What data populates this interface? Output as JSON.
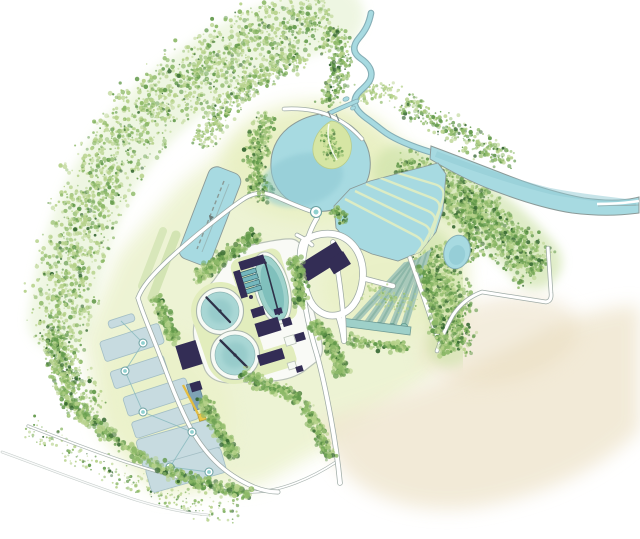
{
  "palette": {
    "paper": "#ffffff",
    "wash_green": "#edf3d2",
    "wash_bright": "#e7efbe",
    "wash_beige": "#f0e7d1",
    "wash_tan": "#e9dcbd",
    "water": "#a7dae1",
    "water_deep": "#8fc9d3",
    "shoreline": "#8b9a98",
    "island_green": "#d6e6a4",
    "lagoon_fill": "#c7dbe0",
    "lagoon_stroke": "#a3bec4",
    "channel_teal": "#9ed0c9",
    "channel_teal_dark": "#6f9a94",
    "strip_teal": "#a8c9ba",
    "berm_pale": "#dcecc4",
    "clarifier_water": "#a9d7d5",
    "clarifier_deep": "#8ac3c3",
    "building": "#332d55",
    "pad_white": "#f9faf6",
    "pad_stroke": "#b9c2b7",
    "ring_white": "#f7faf5",
    "green_patch": "#e2edbd",
    "road_casing": "#9aa7a2",
    "road_fill": "#ffffff",
    "foliage_light": "#b5d189",
    "foliage_mid": "#8db968",
    "foliage_dark": "#639a4b",
    "foliage_deep": "#33652f",
    "node_teal": "#8fd0cf",
    "pipe_yellow": "#e3bc41",
    "pipe_dash": "#8a9a96",
    "arm_dark": "#2e3148"
  },
  "map": {
    "kind": "watercolor-site-plan",
    "features": [
      {
        "id": "inflow-stream",
        "kind": "watercourse"
      },
      {
        "id": "river-channel",
        "kind": "watercourse"
      },
      {
        "id": "meander-pond",
        "kind": "pond"
      },
      {
        "id": "pond-island",
        "kind": "island"
      },
      {
        "id": "pond-outlet-node",
        "kind": "structure"
      },
      {
        "id": "transfer-basin",
        "kind": "basin"
      },
      {
        "id": "serpentine-wetland",
        "kind": "wetland-cells"
      },
      {
        "id": "collection-channel",
        "kind": "channel"
      },
      {
        "id": "polishing-pond",
        "kind": "pond"
      },
      {
        "id": "storage-lagoons",
        "kind": "basin-group"
      },
      {
        "id": "transfer-nodes",
        "kind": "structures"
      },
      {
        "id": "treatment-pad",
        "kind": "paved-area"
      },
      {
        "id": "clarifier-1",
        "kind": "tank"
      },
      {
        "id": "clarifier-2",
        "kind": "tank"
      },
      {
        "id": "aeration-basin",
        "kind": "tank"
      },
      {
        "id": "tank-battery",
        "kind": "tanks"
      },
      {
        "id": "plant-buildings",
        "kind": "buildings"
      },
      {
        "id": "main-building",
        "kind": "building"
      },
      {
        "id": "building-loop-road",
        "kind": "road"
      },
      {
        "id": "access-roads",
        "kind": "roads"
      },
      {
        "id": "rural-roads",
        "kind": "roads"
      },
      {
        "id": "field-boundary-path",
        "kind": "path"
      },
      {
        "id": "pipe-route-yellow",
        "kind": "pipe"
      },
      {
        "id": "tree-arc",
        "kind": "vegetation"
      },
      {
        "id": "woodland",
        "kind": "vegetation"
      },
      {
        "id": "hedgerows",
        "kind": "vegetation"
      },
      {
        "id": "meadow-wash",
        "kind": "landcover"
      },
      {
        "id": "field-wash",
        "kind": "landcover"
      }
    ]
  }
}
